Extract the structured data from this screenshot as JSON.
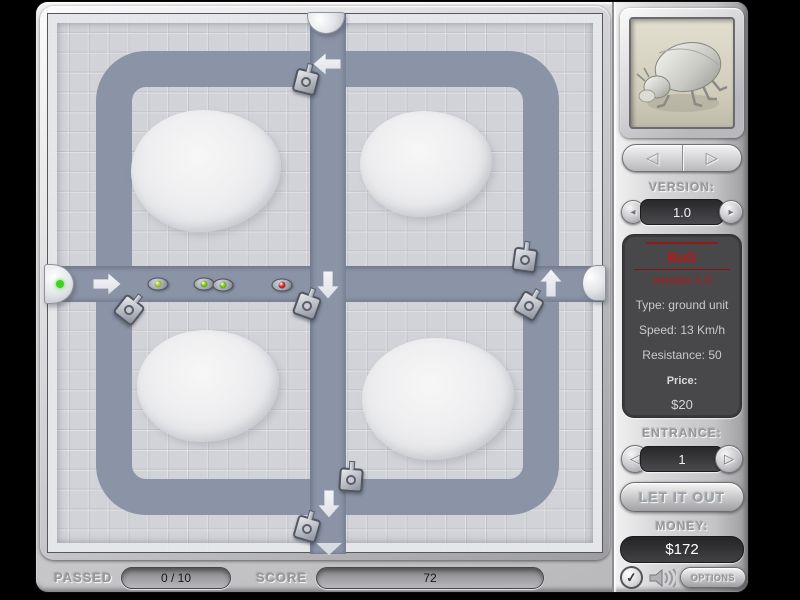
{
  "colors": {
    "path": "#8b93a6",
    "tile": "#d2d3d8",
    "accent_red": "#c01414",
    "active_gate_green": "#3fd321"
  },
  "board": {
    "mounds": [
      {
        "x": 158,
        "y": 157,
        "w": 150,
        "h": 122
      },
      {
        "x": 378,
        "y": 150,
        "w": 132,
        "h": 106
      },
      {
        "x": 160,
        "y": 372,
        "w": 142,
        "h": 112
      },
      {
        "x": 390,
        "y": 385,
        "w": 152,
        "h": 122
      }
    ],
    "arrows": [
      {
        "x": 279,
        "y": 50,
        "dir": "left"
      },
      {
        "x": 59,
        "y": 270,
        "dir": "right"
      },
      {
        "x": 280,
        "y": 271,
        "dir": "down"
      },
      {
        "x": 503,
        "y": 269,
        "dir": "up"
      },
      {
        "x": 281,
        "y": 490,
        "dir": "down"
      }
    ],
    "towers": [
      {
        "x": 258,
        "y": 68,
        "rot": 14
      },
      {
        "x": 81,
        "y": 296,
        "rot": 38
      },
      {
        "x": 259,
        "y": 292,
        "rot": 20
      },
      {
        "x": 477,
        "y": 246,
        "rot": 8
      },
      {
        "x": 481,
        "y": 292,
        "rot": 30
      },
      {
        "x": 303,
        "y": 466,
        "rot": 4
      },
      {
        "x": 259,
        "y": 515,
        "rot": 16
      }
    ],
    "bugs": [
      {
        "x": 110,
        "y": 270,
        "dot": "#a8d32a"
      },
      {
        "x": 156,
        "y": 270,
        "dot": "#7ecb1e"
      },
      {
        "x": 175,
        "y": 271,
        "dot": "#7ecb1e"
      },
      {
        "x": 234,
        "y": 271,
        "dot": "#d32a2a"
      }
    ],
    "gates": [
      {
        "side": "left",
        "x": 11,
        "y": 270,
        "active": true
      },
      {
        "side": "top",
        "x": 278,
        "y": 9,
        "active": false
      },
      {
        "side": "right",
        "x": 546,
        "y": 269,
        "active": false
      },
      {
        "side": "bottom",
        "x": 281,
        "y": 535,
        "active": false
      }
    ]
  },
  "hud": {
    "passed_label": "PASSED",
    "passed_value": "0 / 10",
    "score_label": "SCORE",
    "score_value": "72"
  },
  "sidebar": {
    "portrait_icon": "beetle-icon",
    "nav": {
      "prev_icon": "◁",
      "next_icon": "▷"
    },
    "version": {
      "label": "VERSION:",
      "value": "1.0",
      "prev_icon": "◂",
      "next_icon": "▸"
    },
    "info": {
      "name": "BuG",
      "version_line": "version 1.0",
      "type": "Type: ground unit",
      "speed": "Speed: 13 Km/h",
      "resistance": "Resistance: 50",
      "price_label": "Price:",
      "price_value": "$20"
    },
    "entrance": {
      "label": "ENTRANCE:",
      "value": "1",
      "prev_icon": "◁",
      "next_icon": "▷"
    },
    "release_label": "LET IT OUT",
    "money": {
      "label": "MONEY:",
      "value": "$172"
    },
    "check_icon": "✓",
    "options_label": "OPTIONS"
  }
}
